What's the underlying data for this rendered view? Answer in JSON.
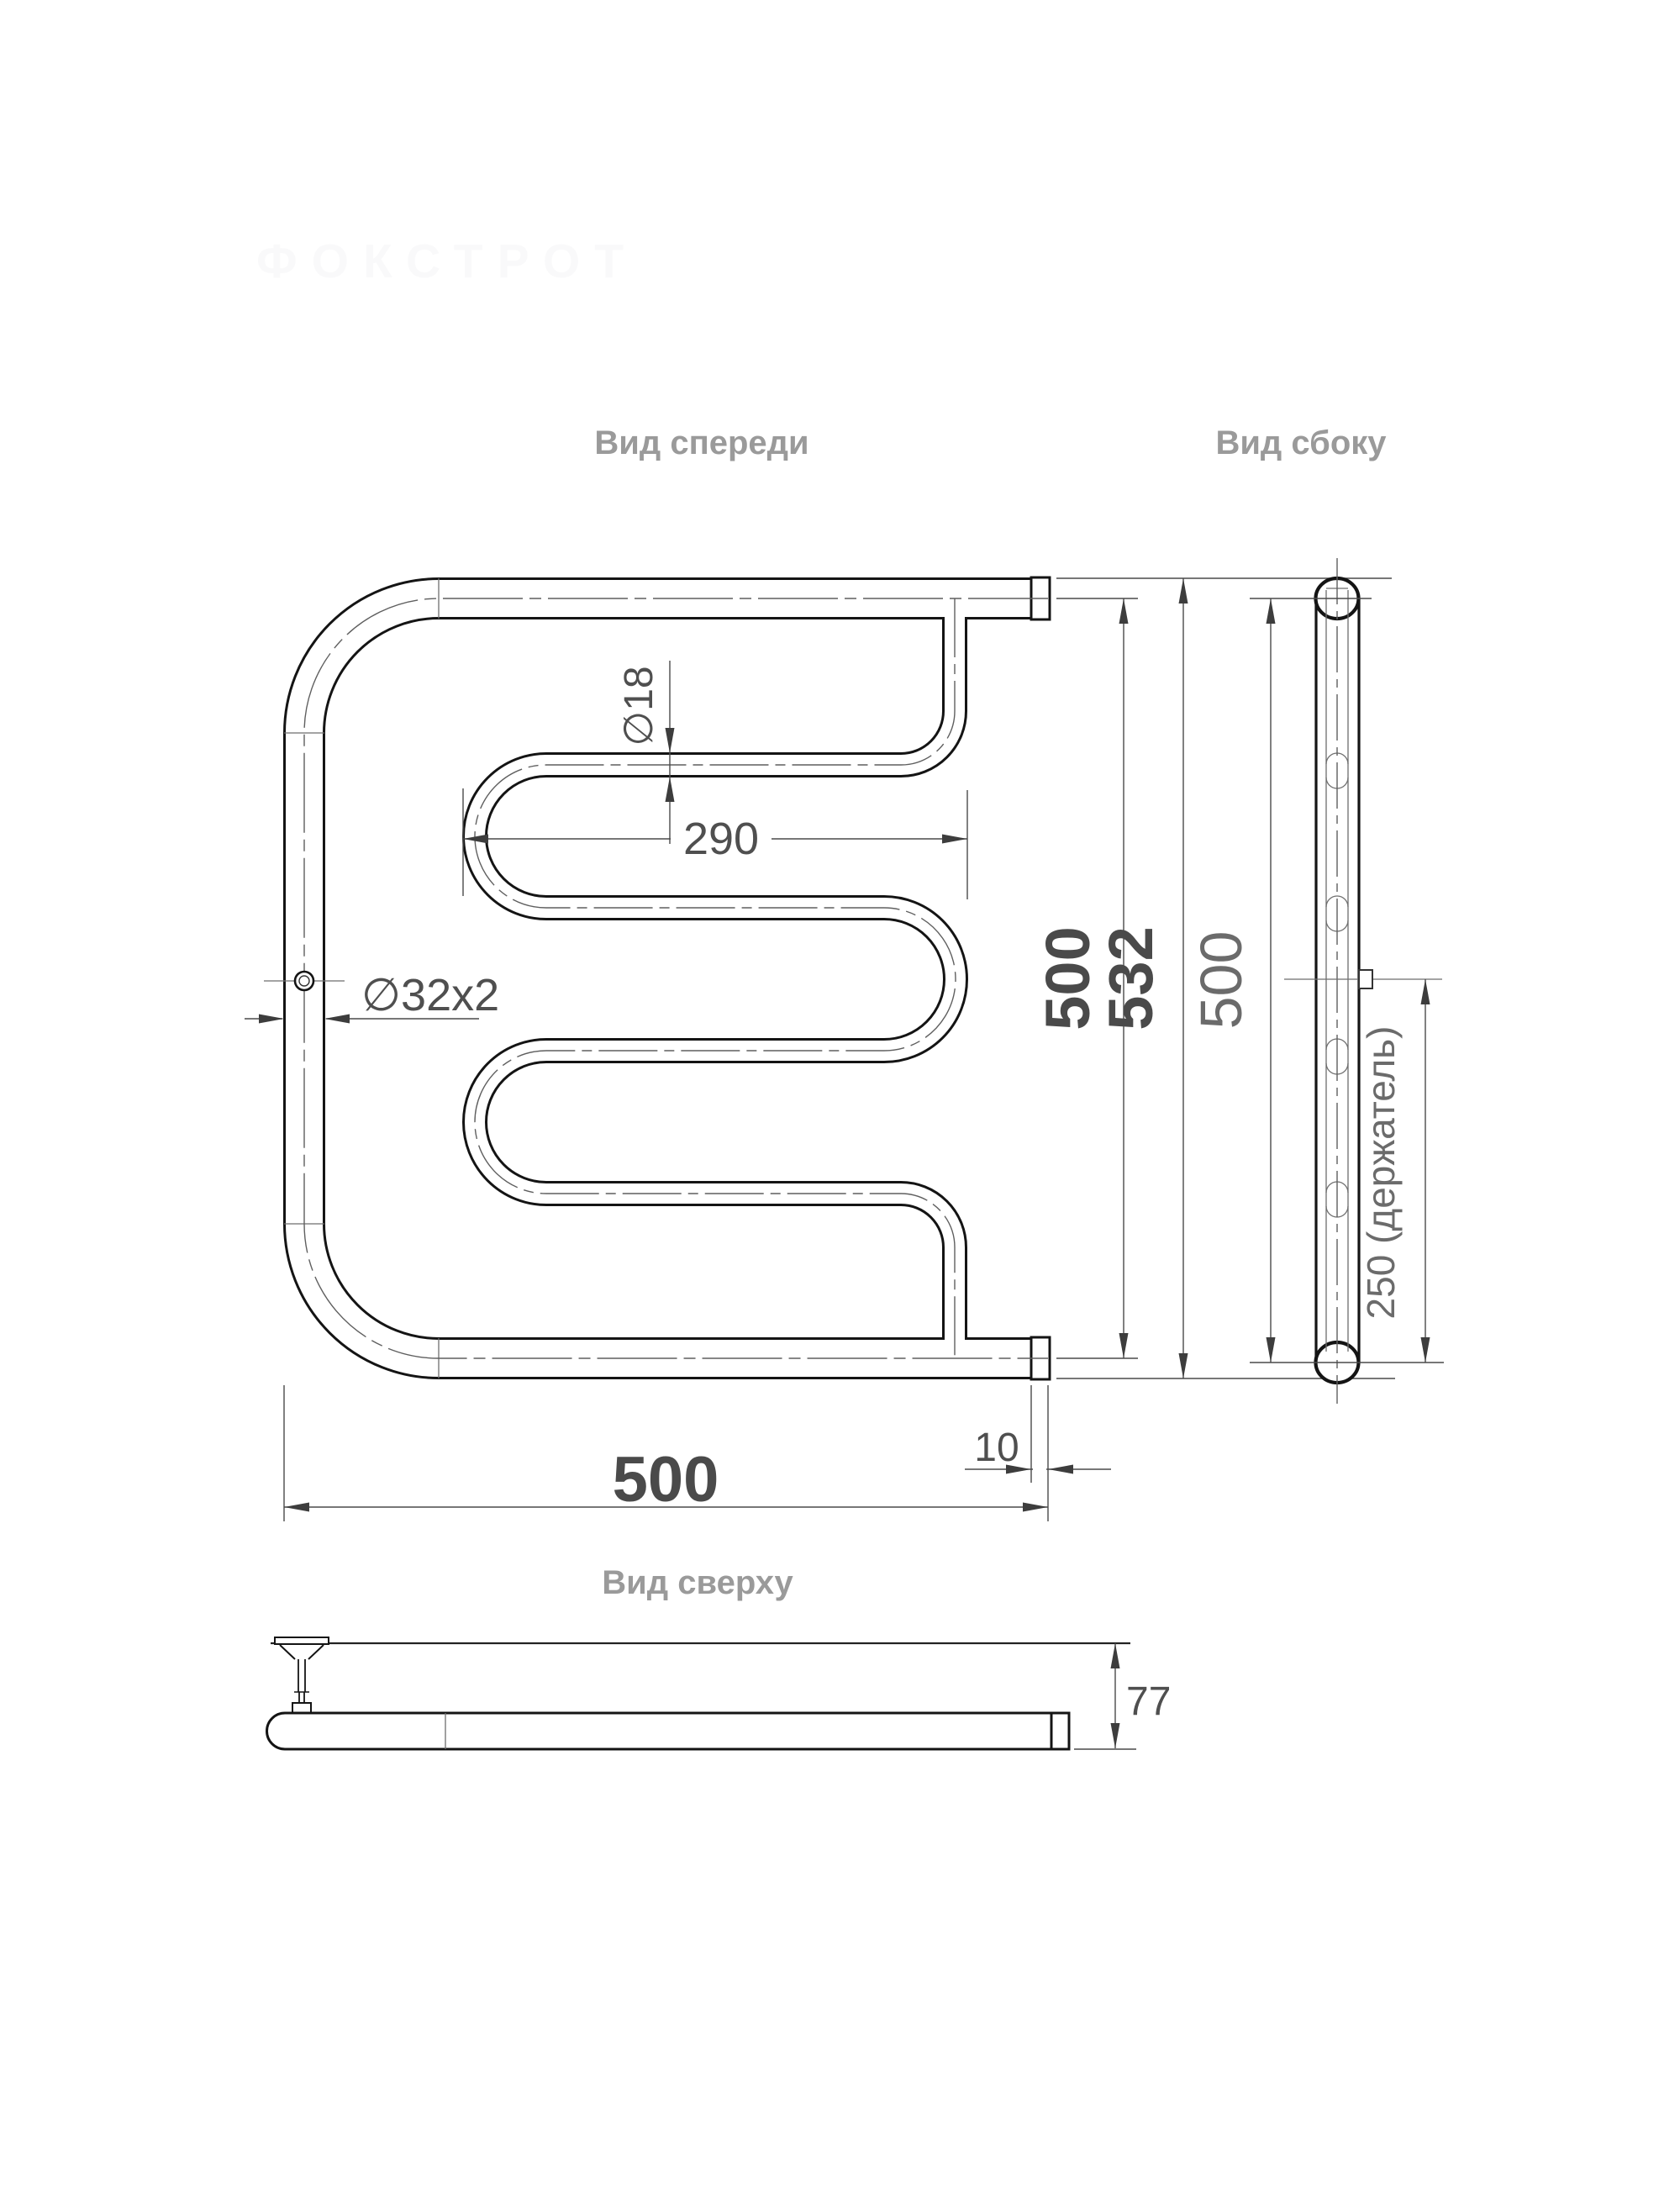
{
  "watermark_text": "ФОКСТРОТ",
  "views": {
    "front": {
      "title": "Вид спереди"
    },
    "side": {
      "title": "Вид сбоку"
    },
    "top": {
      "title": "Вид сверху"
    }
  },
  "dimensions": {
    "pipe_diameter": "∅32x2",
    "serpentine_diameter": "∅18",
    "serpentine_width": "290",
    "height_axes": "500",
    "height_overall": "532",
    "width_overall": "500",
    "end_offset": "10",
    "side_height_axes": "500",
    "holder_spacing": "250 (держатель)",
    "depth": "77"
  },
  "colors": {
    "outline": "#141414",
    "thin_line": "#6e6e6e",
    "dimension_line": "#4a4a4a",
    "label_gray": "#4f4f4f",
    "label_light": "#6b6b6b",
    "title_gray": "#9a9a9a",
    "background": "#ffffff"
  }
}
